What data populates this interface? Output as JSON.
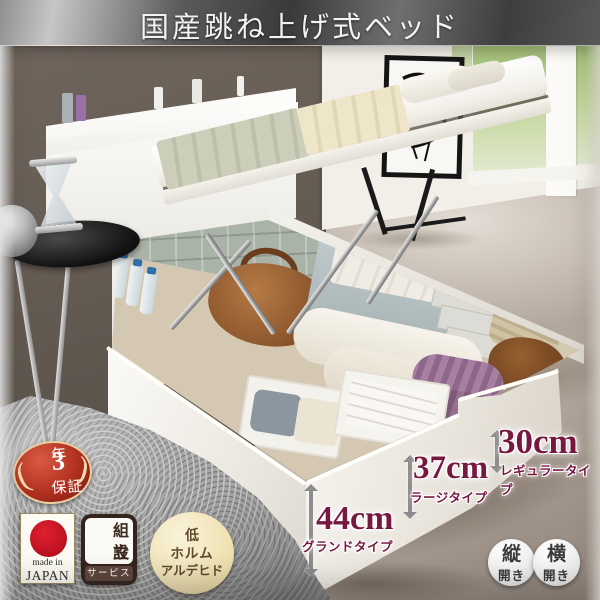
{
  "header": {
    "title": "国産跳ね上げ式ベッド"
  },
  "badges": {
    "warranty": {
      "number": "3",
      "unit": "年",
      "line2": "保証"
    },
    "made_in": {
      "line1": "made in",
      "line2": "JAPAN"
    },
    "assembly": {
      "line1": "組立",
      "line2": "設置",
      "footer": "サービス"
    },
    "low_formaldehyde": {
      "line1": "低",
      "line2": "ホルム",
      "line3": "アルデヒド"
    }
  },
  "measurements": [
    {
      "value": "30cm",
      "type": "レギュラータイプ"
    },
    {
      "value": "37cm",
      "type": "ラージタイプ"
    },
    {
      "value": "44cm",
      "type": "グランドタイプ"
    }
  ],
  "open_types": [
    {
      "char": "縦",
      "suffix": "開き"
    },
    {
      "char": "横",
      "suffix": "開き"
    }
  ],
  "decor": {
    "laurel_left": "(",
    "laurel_right": ")"
  },
  "colors": {
    "measurement_text": "#76183f",
    "warranty_red": "#b03020",
    "japan_flag_red": "#b50f1e",
    "assembly_brown": "#33241d",
    "formaldehyde_cream": "#eedfad",
    "header_dark": "#3a3a3a"
  }
}
